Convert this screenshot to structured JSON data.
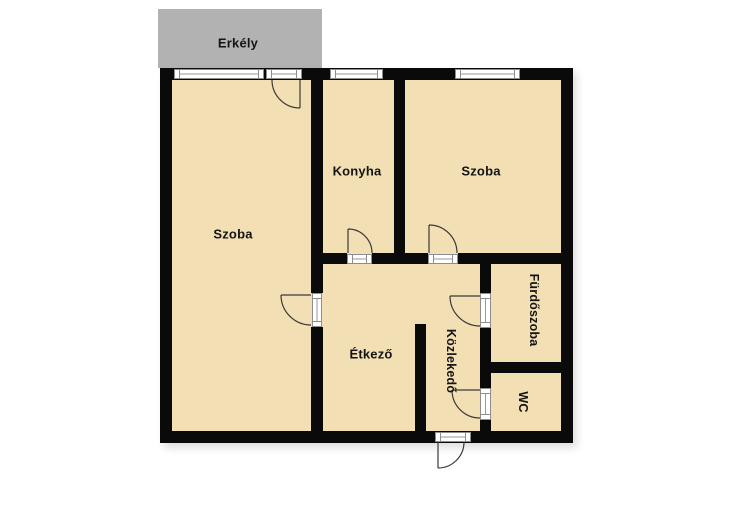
{
  "title": "Apartment floor plan",
  "colors": {
    "room_fill": "#f3dfb4",
    "balcony_fill": "#b2b2b2",
    "wall": "#0a0a0a",
    "background": "#ffffff"
  },
  "balcony": {
    "label": "Erkély"
  },
  "rooms": {
    "szoba_left": {
      "label": "Szoba"
    },
    "konyha": {
      "label": "Konyha"
    },
    "szoba_right": {
      "label": "Szoba"
    },
    "etkezo": {
      "label": "Étkező"
    },
    "kozlekedo": {
      "label": "Közlekedő"
    },
    "furdoszoba": {
      "label": "Fürdőszoba"
    },
    "wc": {
      "label": "WC"
    }
  }
}
